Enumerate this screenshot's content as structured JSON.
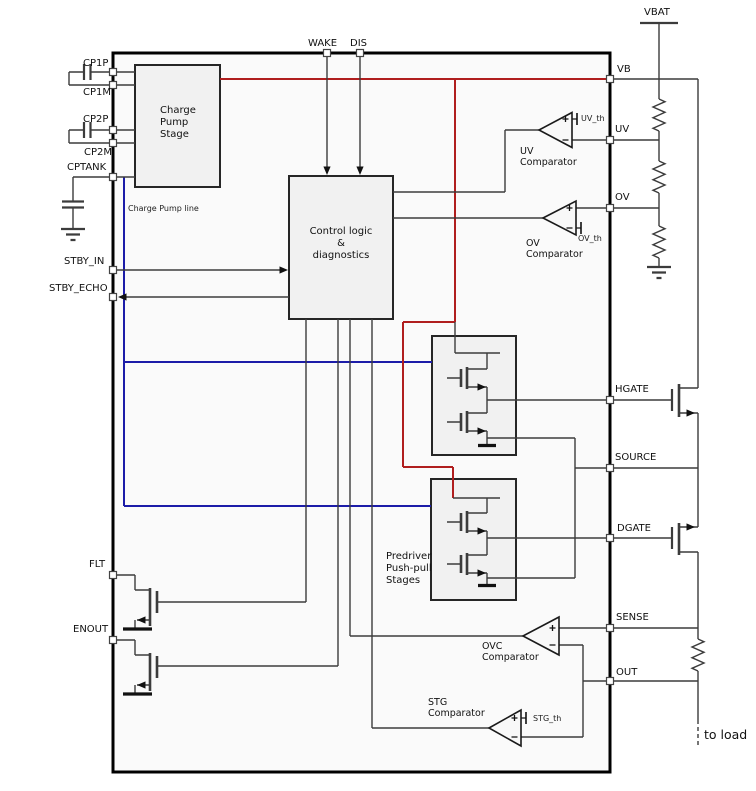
{
  "colors": {
    "supply_red": "#b01e1e",
    "charge_pump_blue": "#1c1ca8",
    "wire": "#3c3c3c"
  },
  "labels": {
    "vbat": "VBAT",
    "to_load": "to load",
    "charge_pump_line": "Charge Pump line"
  },
  "blocks": {
    "charge_pump": "Charge\nPump\nStage",
    "control_logic": "Control logic\n&\ndiagnostics",
    "predriver": "Predriver\nPush-pull\nStages"
  },
  "comparators": {
    "uv": {
      "label": "UV\nComparator",
      "threshold": "UV_th"
    },
    "ov": {
      "label": "OV\nComparator",
      "threshold": "OV_th"
    },
    "ovc": {
      "label": "OVC\nComparator"
    },
    "stg": {
      "label": "STG\nComparator",
      "threshold": "STG_th"
    }
  },
  "pins": {
    "top": [
      {
        "label": "WAKE"
      },
      {
        "label": "DIS"
      }
    ],
    "left": [
      {
        "label": "CP1P"
      },
      {
        "label": "CP1M"
      },
      {
        "label": "CP2P"
      },
      {
        "label": "CP2M"
      },
      {
        "label": "CPTANK"
      },
      {
        "label": "STBY_IN"
      },
      {
        "label": "STBY_ECHO"
      },
      {
        "label": "FLT"
      },
      {
        "label": "ENOUT"
      }
    ],
    "right": [
      {
        "label": "VB"
      },
      {
        "label": "UV"
      },
      {
        "label": "OV"
      },
      {
        "label": "HGATE"
      },
      {
        "label": "SOURCE"
      },
      {
        "label": "DGATE"
      },
      {
        "label": "SENSE"
      },
      {
        "label": "OUT"
      }
    ]
  }
}
